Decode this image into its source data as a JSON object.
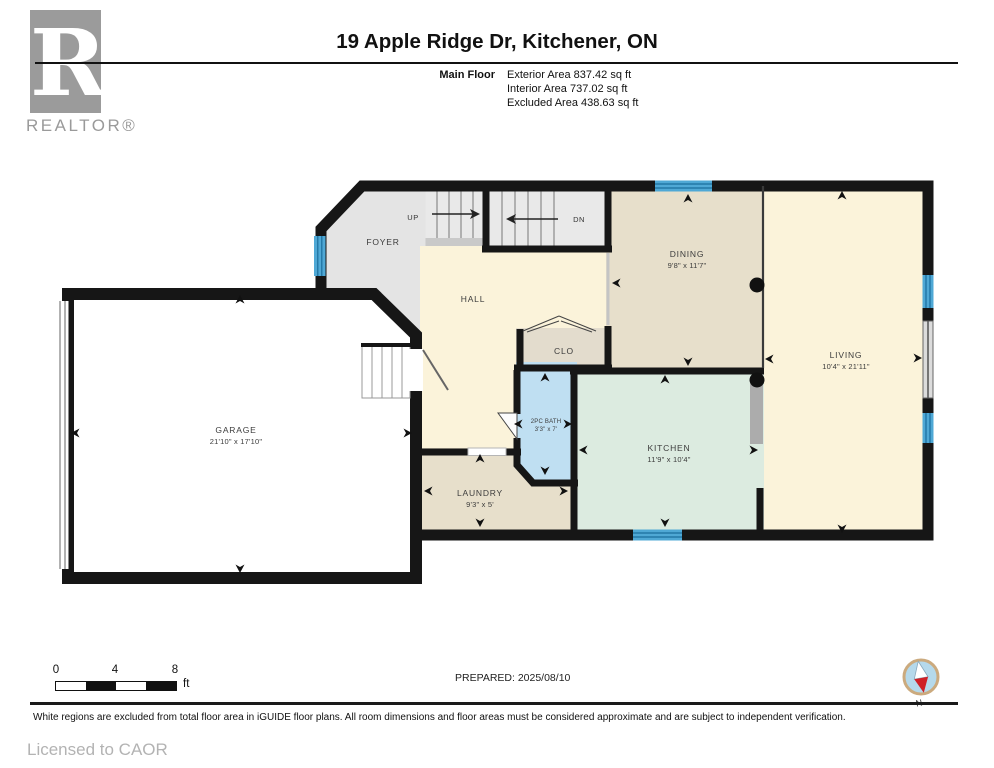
{
  "header": {
    "logo_letter": "R",
    "logo_caption": "REALTOR®",
    "title": "19 Apple Ridge Dr, Kitchener, ON",
    "floor_label": "Main Floor",
    "stats": [
      "Exterior Area 837.42 sq ft",
      "Interior Area 737.02 sq ft",
      "Excluded Area 438.63 sq ft"
    ]
  },
  "plan": {
    "rooms": {
      "garage": {
        "name": "GARAGE",
        "dims": "21'10\" x 17'10\""
      },
      "foyer": {
        "name": "FOYER",
        "dims": ""
      },
      "hall": {
        "name": "HALL",
        "dims": ""
      },
      "clo": {
        "name": "CLO",
        "dims": ""
      },
      "dining": {
        "name": "DINING",
        "dims": "9'8\" x 11'7\""
      },
      "living": {
        "name": "LIVING",
        "dims": "10'4\" x 21'11\""
      },
      "kitchen": {
        "name": "KITCHEN",
        "dims": "11'9\" x 10'4\""
      },
      "bath": {
        "name": "2PC BATH",
        "dims": "3'3\" x 7'"
      },
      "laundry": {
        "name": "LAUNDRY",
        "dims": "9'3\" x 5'"
      }
    },
    "stairs": {
      "up": "UP",
      "down": "DN"
    }
  },
  "footer": {
    "scale": {
      "ticks": [
        "0",
        "4",
        "8"
      ],
      "unit": "ft"
    },
    "prepared": "PREPARED: 2025/08/10",
    "compass_label": "N",
    "disclaimer": "White regions are excluded from total floor area in iGUIDE floor plans. All room dimensions and floor areas must be considered approximate and are subject to independent verification.",
    "license": "Licensed to CAOR"
  },
  "colors": {
    "wall": "#161616",
    "window_blue": "#4fa8d5",
    "window_line": "#1a6e9e",
    "bath_blue": "#bfdff2",
    "cream": "#fbf3da",
    "tan": "#e7dfcb",
    "clo_tan": "#e3dccd",
    "mint": "#dcebe0",
    "foyer_gray": "#e4e4e4",
    "stair_gray": "#e9e9e9",
    "garage_white": "#ffffff",
    "counter_gray": "#acacac",
    "logo_gray": "#9b9b9b",
    "compass_fill": "#b5d9eb",
    "compass_ring": "#cbaa7e",
    "compass_red": "#cf2026"
  }
}
